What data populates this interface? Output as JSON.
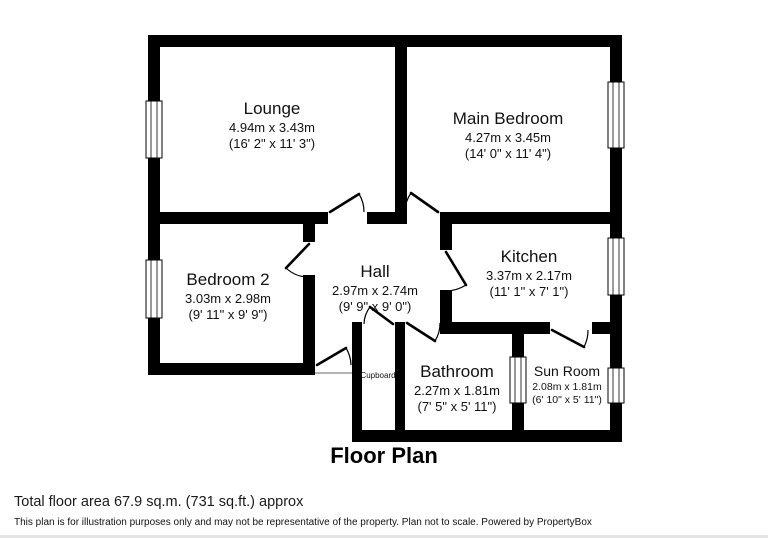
{
  "title": "Floor Plan",
  "rooms": [
    {
      "name": "Lounge",
      "metric": "4.94m x 3.43m",
      "imperial": "(16' 2\" x 11' 3\")"
    },
    {
      "name": "Main Bedroom",
      "metric": "4.27m x 3.45m",
      "imperial": "(14' 0\" x 11' 4\")"
    },
    {
      "name": "Bedroom 2",
      "metric": "3.03m x 2.98m",
      "imperial": "(9' 11\" x 9' 9\")"
    },
    {
      "name": "Hall",
      "metric": "2.97m x 2.74m",
      "imperial": "(9' 9\" x 9' 0\")"
    },
    {
      "name": "Kitchen",
      "metric": "3.37m x 2.17m",
      "imperial": "(11' 1\" x 7' 1\")"
    },
    {
      "name": "Bathroom",
      "metric": "2.27m x 1.81m",
      "imperial": "(7' 5\" x 5' 11\")"
    },
    {
      "name": "Sun Room",
      "metric": "2.08m x 1.81m",
      "imperial": "(6' 10\" x 5' 11\")"
    },
    {
      "name": "Cupboard"
    }
  ],
  "footer": {
    "area_line": "Total floor area 67.9 sq.m. (731 sq.ft.) approx",
    "disclaimer": "This plan is for illustration purposes only and may not be representative of the property. Plan not to scale. Powered by PropertyBox"
  },
  "colors": {
    "wall": "#000000",
    "background": "#ffffff",
    "text": "#1a1a1a"
  }
}
